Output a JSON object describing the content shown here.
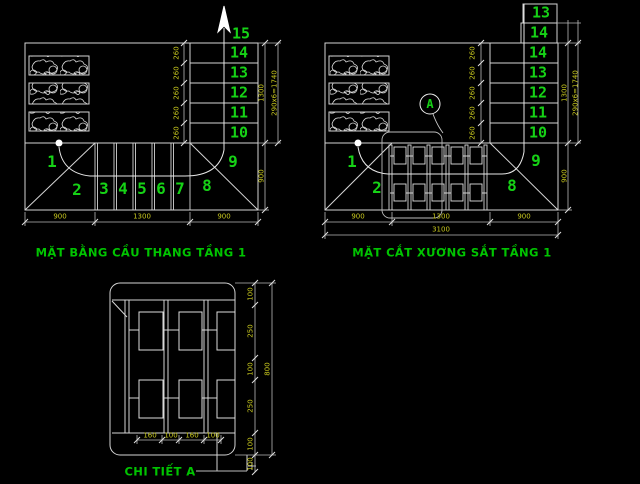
{
  "colors": {
    "background": "#000000",
    "linework": "#d4d4d4",
    "step_numbers": "#16d216",
    "titles": "#00c400",
    "dimensions": "#c8c81e"
  },
  "plan": {
    "title": "MẶT BẰNG CẦU THANG TẦNG 1",
    "steps": [
      "1",
      "2",
      "3",
      "4",
      "5",
      "6",
      "7",
      "8",
      "9",
      "10",
      "11",
      "12",
      "13",
      "14",
      "15"
    ],
    "tread_dims": [
      "260",
      "260",
      "260",
      "260",
      "260"
    ],
    "dim_bottom": [
      "900",
      "1300",
      "900"
    ],
    "dim_right_run": "1300",
    "dim_right_total": "290x6=1740",
    "dim_right_landing": "900"
  },
  "section": {
    "title": "MẶT CẮT XƯƠNG SẮT TẦNG 1",
    "callout_label": "A",
    "steps": [
      "1",
      "2",
      "8",
      "9",
      "10",
      "11",
      "12",
      "13",
      "14"
    ],
    "steps_above": [
      "13",
      "14"
    ],
    "tread_dims": [
      "260",
      "260",
      "260",
      "260",
      "260"
    ],
    "dim_bottom": [
      "900",
      "1300",
      "900"
    ],
    "dim_total": "3100",
    "dim_right_run": "1300",
    "dim_right_total": "290x6=1740",
    "dim_right_landing": "900"
  },
  "detail": {
    "title": "CHI TIẾT A",
    "dim_right": [
      "100",
      "250",
      "100",
      "250",
      "100"
    ],
    "dim_right_total": "800",
    "dim_right_extra": "100",
    "dim_bottom": [
      "160",
      "100",
      "160",
      "100"
    ]
  }
}
